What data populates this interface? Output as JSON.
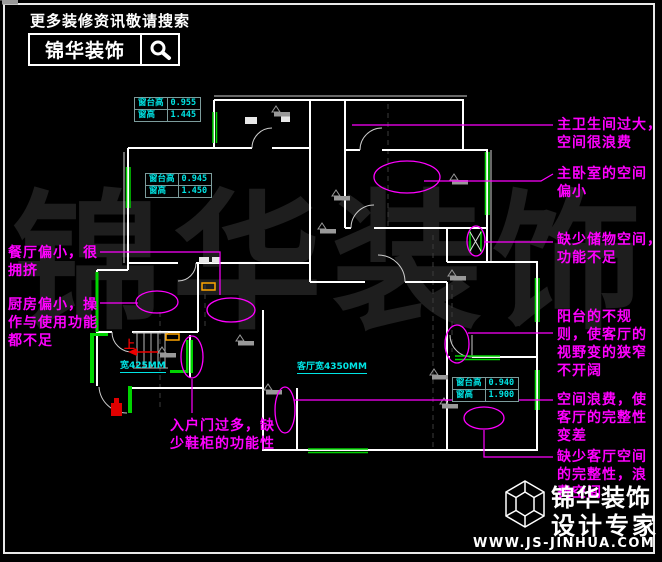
{
  "header": {
    "tagline": "更多装修资讯敬请搜索",
    "brand": "锦华装饰"
  },
  "watermark": {
    "text": "锦华装饰"
  },
  "annotations": [
    {
      "id": "master-bath",
      "text": "主卫生间过大，\n空间很浪费"
    },
    {
      "id": "master-bedroom",
      "text": "主卧室的空间\n偏小"
    },
    {
      "id": "storage",
      "text": "缺少储物空间，\n功能不足"
    },
    {
      "id": "balcony",
      "text": "阳台的不规\n则，使客厅的\n视野变的狭窄\n不开阔"
    },
    {
      "id": "space-waste",
      "text": "空间浪费，使\n客厅的完整性\n变差"
    },
    {
      "id": "living-integrity",
      "text": "缺少客厅空间\n的完整性，浪\n费空间"
    },
    {
      "id": "dining",
      "text": "餐厅偏小，很\n拥挤"
    },
    {
      "id": "kitchen",
      "text": "厨房偏小，操\n作与使用功能\n都不足"
    },
    {
      "id": "entry",
      "text": "入户门过多，缺\n少鞋柜的功能性"
    }
  ],
  "dimension_tables": [
    {
      "rows": [
        [
          "窗台高",
          "0.955"
        ],
        [
          "窗高",
          "1.445"
        ]
      ]
    },
    {
      "rows": [
        [
          "窗台高",
          "0.945"
        ],
        [
          "窗高",
          "1.450"
        ]
      ]
    },
    {
      "rows": [
        [
          "窗台高",
          "0.940"
        ],
        [
          "窗高",
          "1.900"
        ]
      ]
    }
  ],
  "dimension_labels": [
    {
      "text": "宽425MM"
    },
    {
      "text": "客厅宽4350MM"
    }
  ],
  "plan": {
    "up_label": "上"
  },
  "footer": {
    "brand": "锦华装饰",
    "subtitle": "设计专家",
    "website": "WWW.JS-JINHUA.COM"
  },
  "colors": {
    "annotation": "#ff00ff",
    "dimension": "#00e5e5",
    "window": "#00d400",
    "wall": "#ffffff",
    "alert": "#ee0000",
    "highlight": "#ffa500"
  }
}
